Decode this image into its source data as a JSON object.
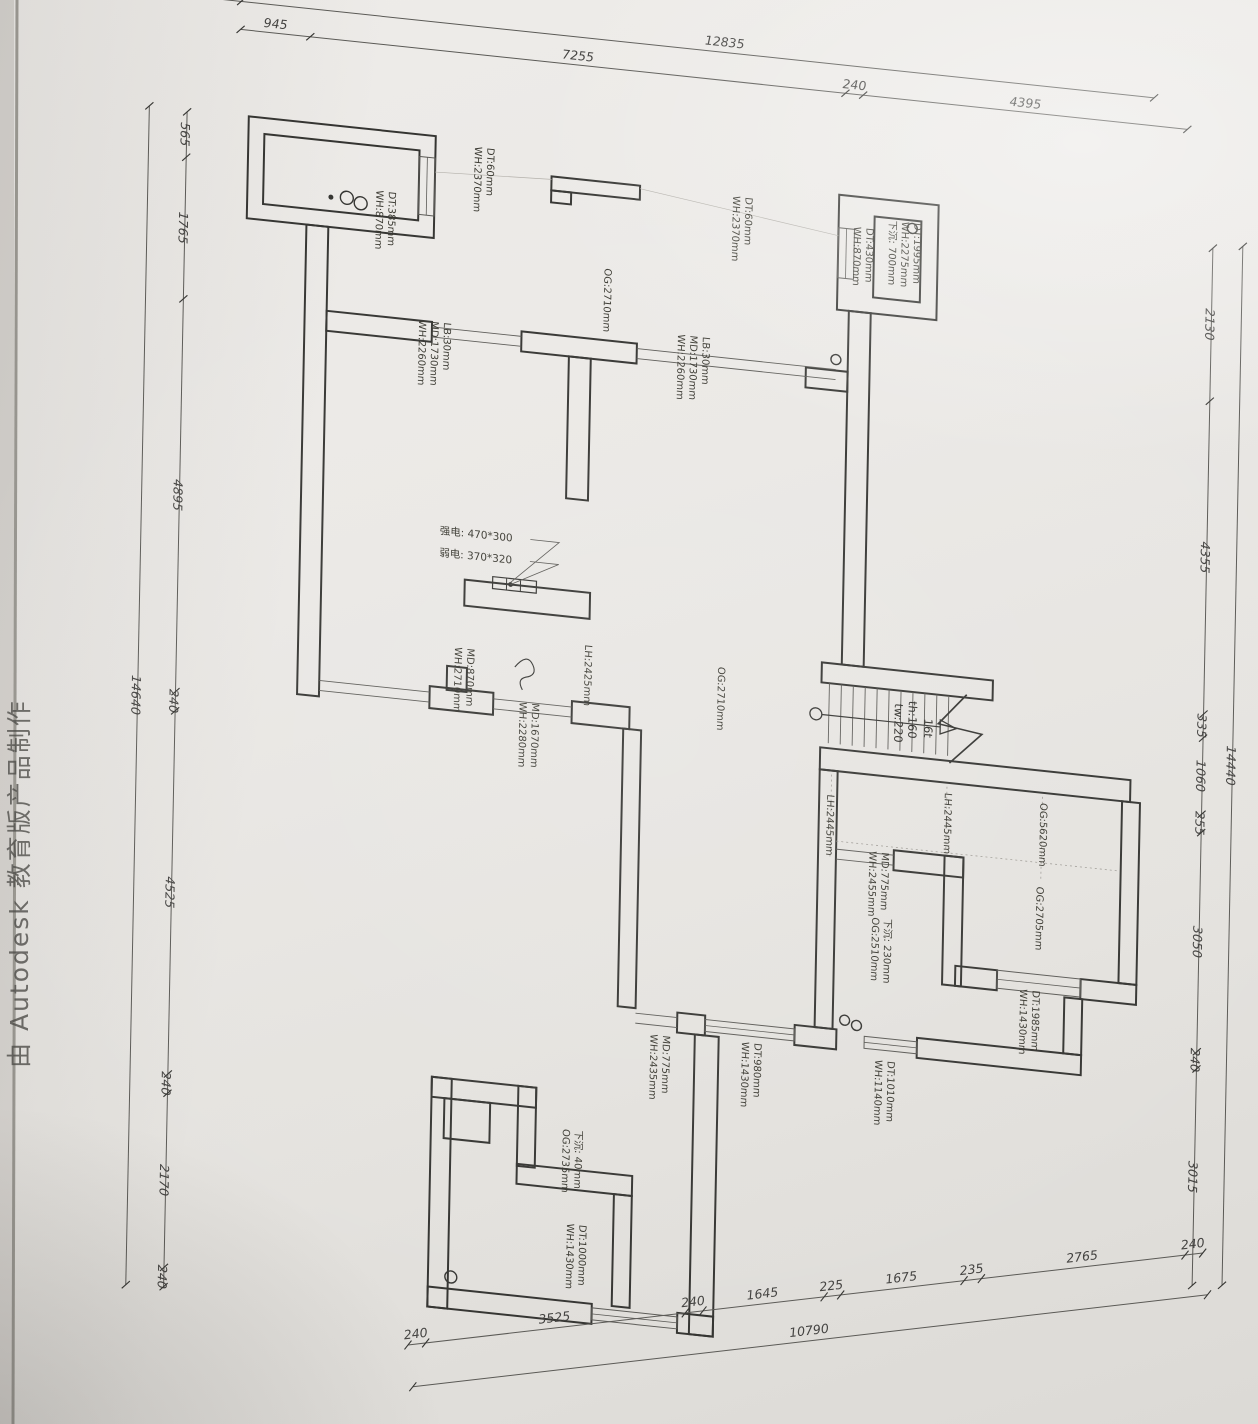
{
  "watermark": "由 Autodesk 教育版产品制作",
  "dimensions": {
    "top": {
      "overall": "12835",
      "chain": [
        "945",
        "7255",
        "240",
        "4395"
      ]
    },
    "bottom": {
      "overall": "10790",
      "chain": [
        "240",
        "3525",
        "240",
        "1645",
        "225",
        "1675",
        "235",
        "2765",
        "240"
      ]
    },
    "left": {
      "overall": "14640",
      "chain": [
        "565",
        "1765",
        "4895",
        "240",
        "4525",
        "240",
        "2170",
        "240"
      ]
    },
    "right": {
      "overall": "14440",
      "chain": [
        "2130",
        "4355",
        "335",
        "1060",
        "255",
        "3050",
        "240",
        "3015"
      ]
    }
  },
  "stairs": {
    "treads": "16t",
    "riser_height": "th:160",
    "tread_width": "tw:220"
  },
  "electrical": {
    "strong": "强电: 470*300",
    "weak": "弱电: 370*320"
  },
  "annotations": {
    "a1": [
      "DT:385mm",
      "WH:870mm"
    ],
    "a2": [
      "DT:60mm",
      "WH:2370mm"
    ],
    "a3": [
      "DT:60mm",
      "WH:2370mm"
    ],
    "a4": [
      "OG:2710mm"
    ],
    "a5": [
      "DT:1995mm",
      "WH:2275mm",
      "下沉: 700mm"
    ],
    "a6": [
      "DT:430mm",
      "WH:870mm"
    ],
    "a7": [
      "LB:30mm",
      "MD:1730mm",
      "WH:2260mm"
    ],
    "a8": [
      "LB:30mm",
      "MD:1730mm",
      "WH:2260mm"
    ],
    "a9": [
      "MD:870mm",
      "WH:2710mm"
    ],
    "a10": [
      "LH:2425mm"
    ],
    "a11": [
      "MD:1670mm",
      "WH:2280mm"
    ],
    "a12": [
      "OG:2710mm"
    ],
    "a13": [
      "LH:2445mm"
    ],
    "a14": [
      "LH:2445mm"
    ],
    "a15": [
      "OG:5620mm"
    ],
    "a16": [
      "OG:2705mm"
    ],
    "a17": [
      "MD:775mm",
      "WH:2455mm"
    ],
    "a18": [
      "下沉: 230mm",
      "OG:2510mm"
    ],
    "a19": [
      "DT:1985mm",
      "WH:1430mm"
    ],
    "a20": [
      "DT:1010mm",
      "WH:1140mm"
    ],
    "a21": [
      "MD:775mm",
      "WH:2435mm"
    ],
    "a22": [
      "DT:980mm",
      "WH:1430mm"
    ],
    "a23": [
      "下沉: 40mm",
      "OG:2735mm"
    ],
    "a24": [
      "DT:1000mm",
      "WH:1430mm"
    ]
  }
}
